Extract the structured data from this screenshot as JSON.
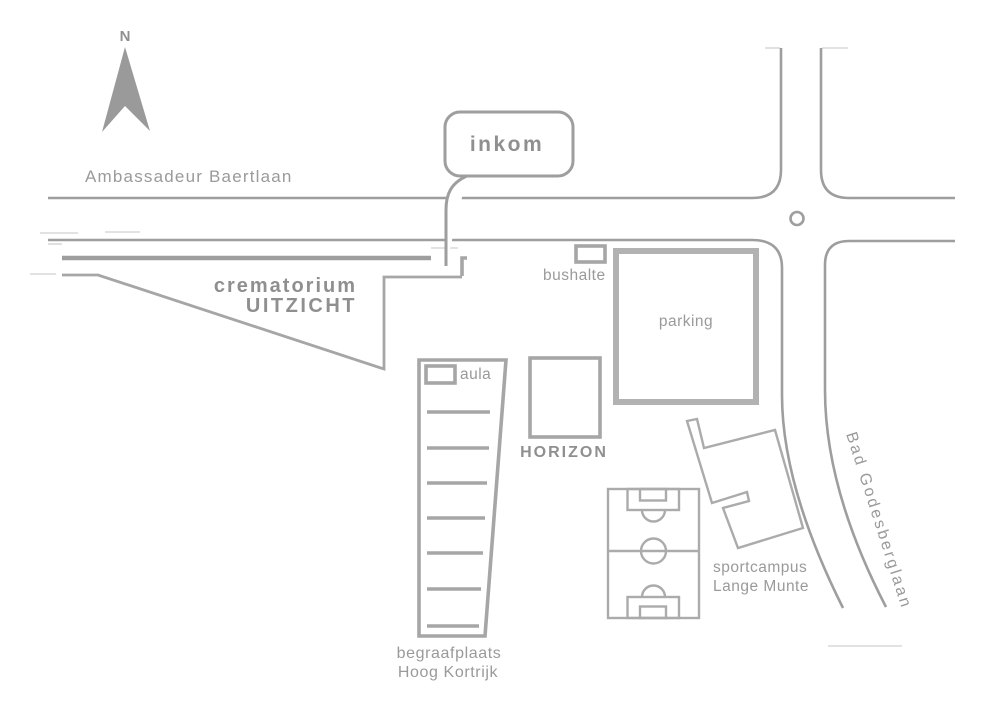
{
  "compass": {
    "north": "N"
  },
  "streets": {
    "ambassadeur_baertlaan": "Ambassadeur Baertlaan",
    "bad_godesberglaan": "Bad Godesberglaan"
  },
  "callout": {
    "inkom": "inkom"
  },
  "sites": {
    "crematorium": [
      "crematorium",
      "UITZICHT"
    ],
    "bushalte": "bushalte",
    "parking": "parking",
    "aula": "aula",
    "horizon": "HORIZON",
    "begraafplaats": [
      "begraafplaats",
      "Hoog Kortrijk"
    ],
    "sportcampus": [
      "sportcampus",
      "Lange Munte"
    ]
  },
  "colors": {
    "road_line": "#9e9e9e",
    "building_line": "#a6a6a6",
    "thick_line": "#b2b2b2",
    "field_line": "#ababab",
    "text": "#9a9a9a",
    "bold_text": "#8f8f8f",
    "faint_line": "#d9d9d9",
    "background": "#ffffff"
  }
}
